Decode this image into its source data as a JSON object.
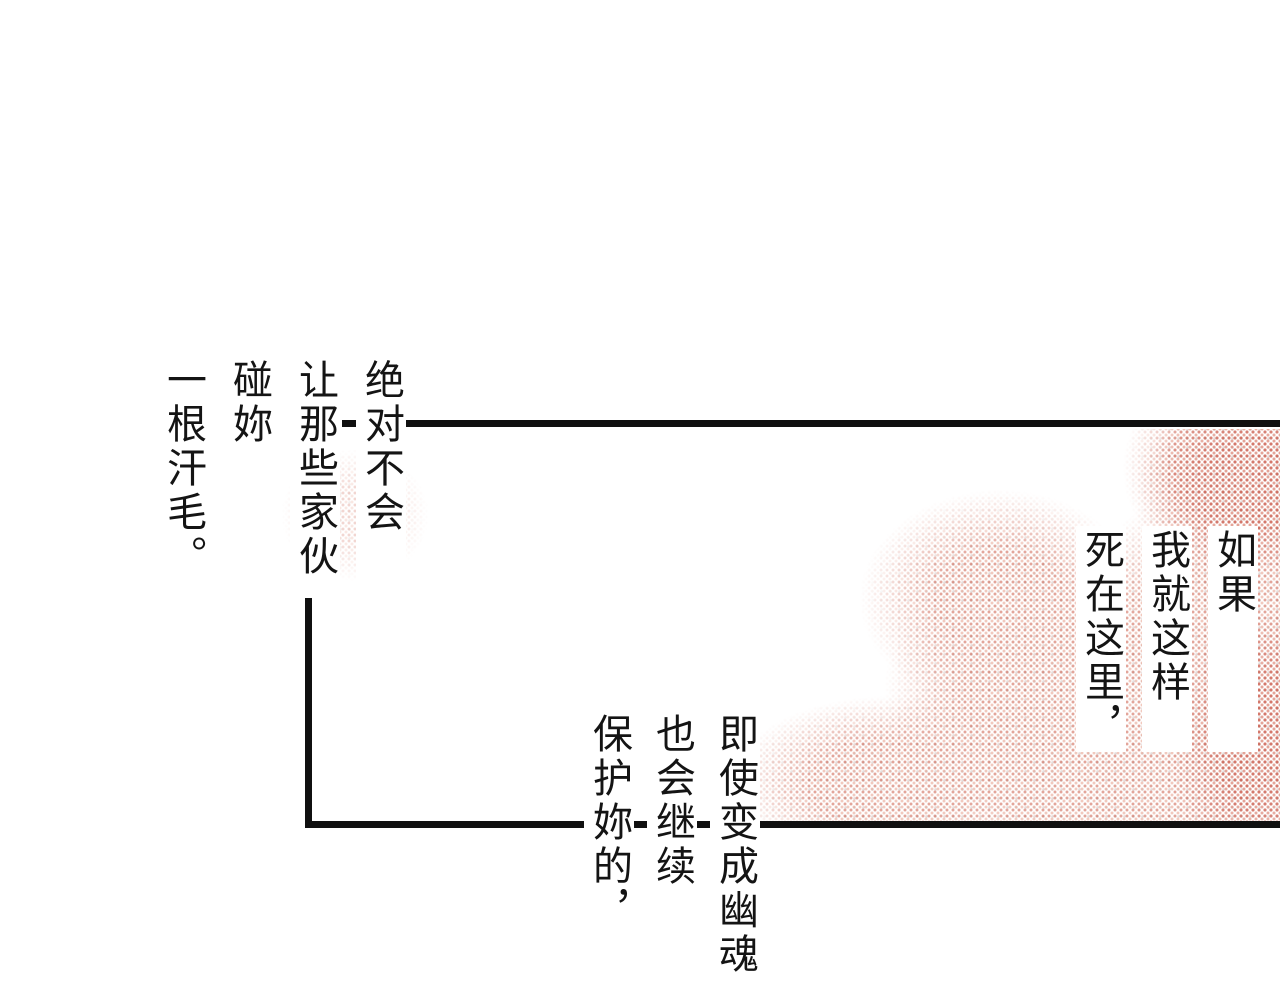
{
  "page": {
    "background_color": "#ffffff",
    "line_color": "#101010",
    "halftone_colors": [
      "#c9523e",
      "#e28e78",
      "#968280"
    ]
  },
  "speech": {
    "top_left": {
      "columns": [
        "绝对不会",
        "让那些家伙",
        "碰妳",
        "一根汗毛。"
      ]
    },
    "middle_right": {
      "columns": [
        "如果",
        "我就这样",
        "死在这里，"
      ]
    },
    "bottom_center": {
      "columns": [
        "即使变成幽魂",
        "也会继续",
        "保护妳的，"
      ]
    }
  }
}
